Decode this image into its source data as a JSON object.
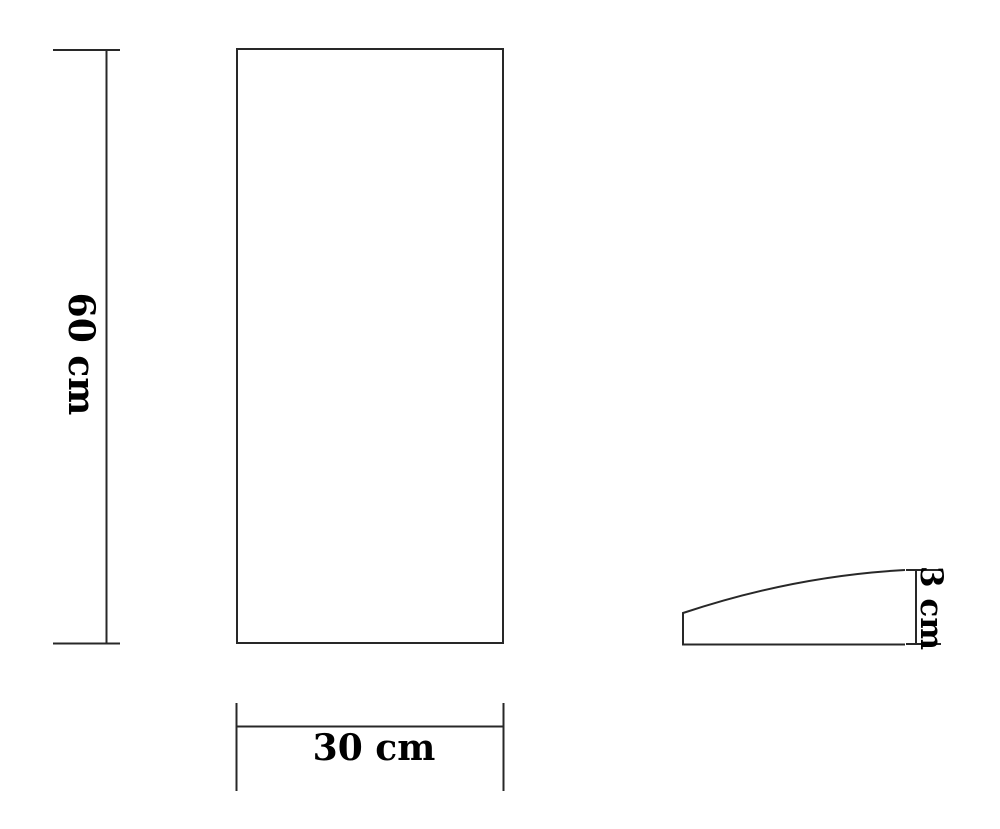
{
  "dimensions": {
    "height_label": "60 cm",
    "width_label": "30 cm",
    "thickness_label": "3 cm"
  },
  "colors": {
    "line": "#282828",
    "text": "#000000",
    "background": "#ffffff"
  }
}
